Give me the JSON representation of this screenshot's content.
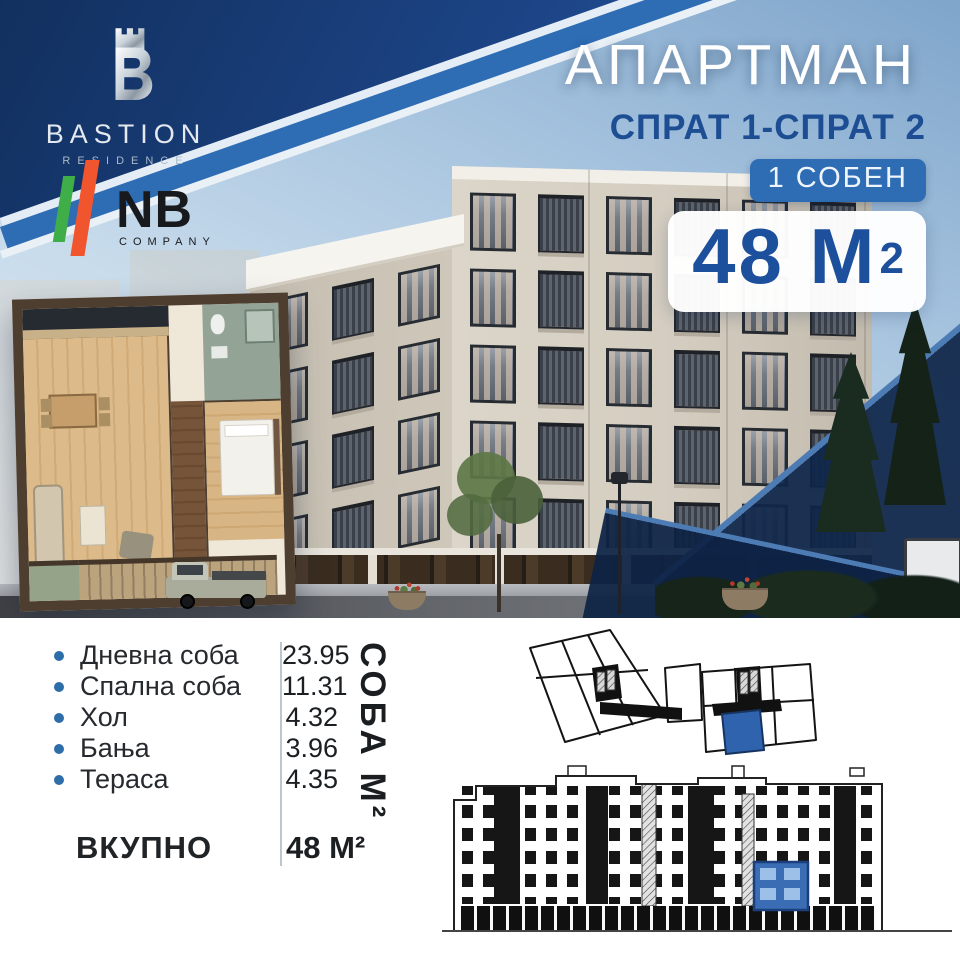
{
  "branding": {
    "bastion": {
      "title": "BASTION",
      "subtitle": "RESIDENCE"
    },
    "nb": {
      "title": "NB",
      "subtitle": "COMPANY"
    }
  },
  "offer": {
    "title": "АПАРТМАН",
    "floors": "СПРАТ 1-СПРАТ 2",
    "type_badge": "1 СОБЕН",
    "area_value": "48 М",
    "area_sup": "2"
  },
  "rooms": {
    "items": [
      {
        "label": "Дневна соба",
        "value": "23.95"
      },
      {
        "label": "Спална соба",
        "value": "11.31"
      },
      {
        "label": "Хол",
        "value": "4.32"
      },
      {
        "label": "Бања",
        "value": "3.96"
      },
      {
        "label": "Тераса",
        "value": "4.35"
      }
    ],
    "axis_label": "СОБА М²",
    "total_label": "ВКУПНО",
    "total_value": "48 М²"
  },
  "icons": {
    "bastion_logo": "castle-tower-icon",
    "nb_logo": "two-stripes-icon",
    "room_bullet": "dot-icon"
  },
  "colors": {
    "navy_band": "#1c4486",
    "accent_blue": "#2e6cb4",
    "heading_blue": "#1d4e94",
    "badge_bg": "#2e6cb4",
    "highlight_unit": "#2f63ae",
    "bullet": "#2d6da8",
    "nb_green": "#3fae49",
    "nb_orange": "#f1552d",
    "facade": "#d3ccbf"
  }
}
